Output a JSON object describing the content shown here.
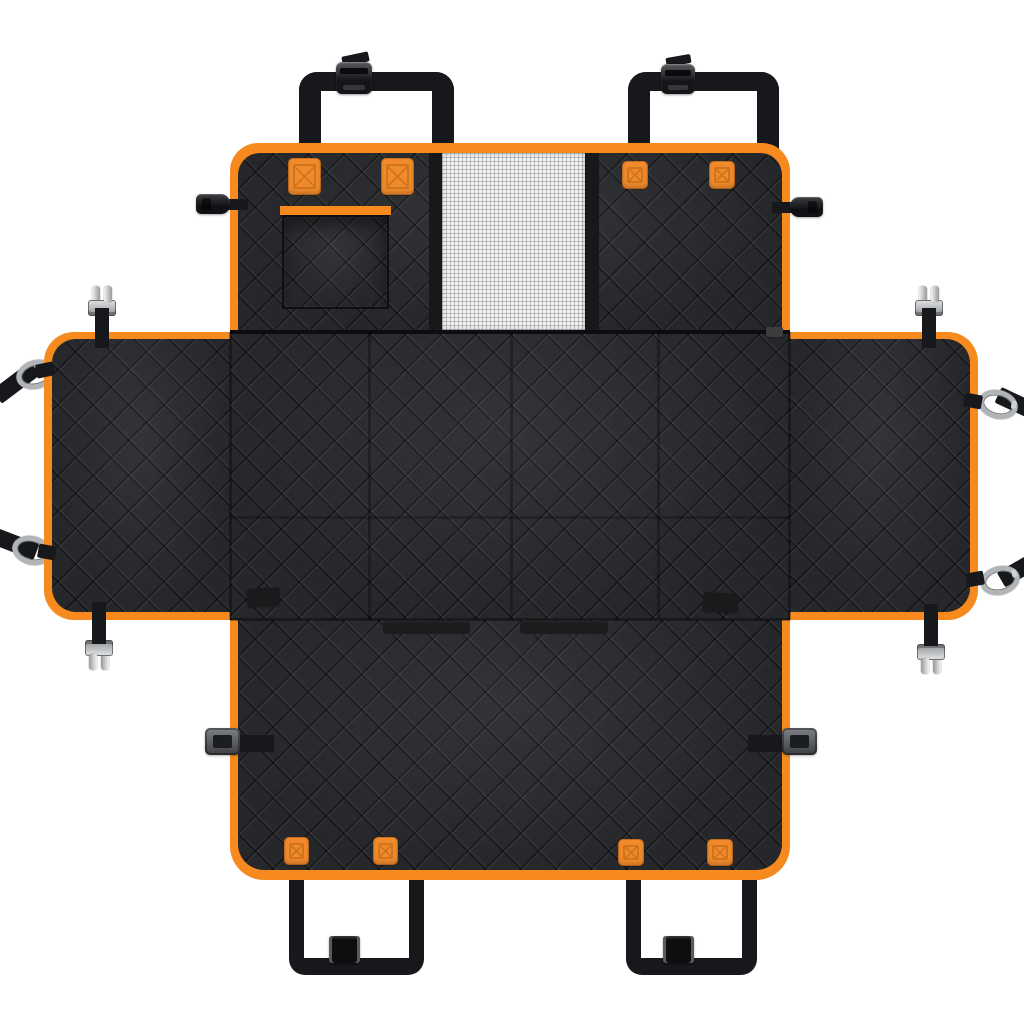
{
  "scene": {
    "type": "product-photo",
    "subject": "Black quilted dog car seat cover hammock with orange trim, unfolded flat-lay top view on white background",
    "view": "top-down"
  },
  "colors": {
    "background": "#ffffff",
    "fabric": "#27292c",
    "fabric_dark": "#17181a",
    "trim": "#f68a1e",
    "tab": "#f18a2d",
    "stitch": "#c56f15",
    "strap": "#17181b",
    "mesh_bg": "#f4f4f4",
    "mesh_line": "#b9bcbf",
    "metal_light": "#e6e7e8",
    "metal_dark": "#8e9194"
  },
  "parts": [
    {
      "name": "backrest-panel",
      "count": 1,
      "description": "top quilted panel with orange edge trim"
    },
    {
      "name": "mesh-window",
      "count": 1,
      "description": "white see-through mesh in backrest center"
    },
    {
      "name": "storage-pocket",
      "count": 1,
      "description": "square pocket with orange top trim on backrest left"
    },
    {
      "name": "headrest-straps",
      "count": 2,
      "description": "black loops with side-release buckles at top"
    },
    {
      "name": "seat-panel",
      "count": 1,
      "description": "large center quilted hammock panel"
    },
    {
      "name": "side-flap-left",
      "count": 1
    },
    {
      "name": "side-flap-right",
      "count": 1
    },
    {
      "name": "carabiner-straps",
      "count": 4,
      "description": "black straps with silver snap hooks on side flaps"
    },
    {
      "name": "metal-cam-clips",
      "count": 4,
      "description": "silver adjuster clips on flap edges"
    },
    {
      "name": "orange-reinforcement-tabs",
      "count": 8,
      "description": "orange squares with X box stitching"
    },
    {
      "name": "zipper",
      "count": 1,
      "description": "horizontal zipper between backrest and seat panel"
    },
    {
      "name": "velcro-strips",
      "count": 2,
      "description": "dark strips on seam above front panel"
    },
    {
      "name": "side-release-buckles",
      "count": 2,
      "description": "black buckles protruding from backrest sides"
    },
    {
      "name": "plastic-side-clips",
      "count": 2,
      "description": "gray clips protruding from front panel sides"
    },
    {
      "name": "anchor-straps",
      "count": 2,
      "description": "black loops with slide adjusters at bottom"
    }
  ]
}
